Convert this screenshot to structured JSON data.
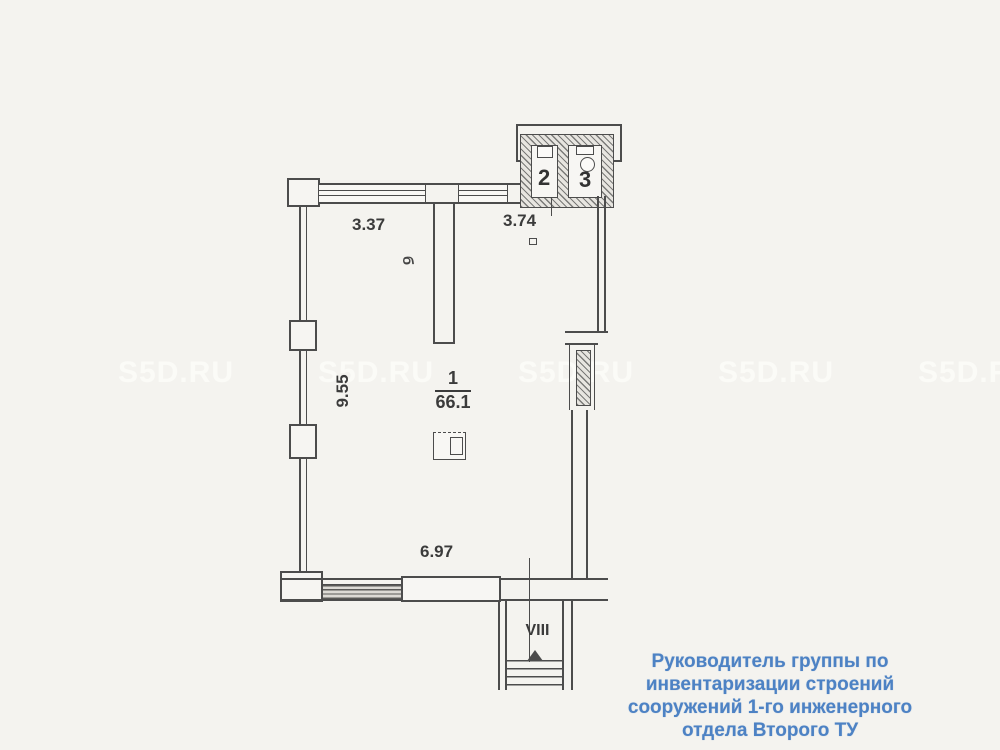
{
  "colors": {
    "background": "#f4f3ef",
    "line": "#4c4c4c",
    "signature_blue": "#4d82c4",
    "watermark": "#fdfdfa"
  },
  "watermark": {
    "text": "S5D.RU"
  },
  "plan": {
    "room1": {
      "number": "1",
      "area": "66.1"
    },
    "room2": {
      "number": "2"
    },
    "room3": {
      "number": "3"
    },
    "dim_top_left": "3.37",
    "dim_top_right": "3.74",
    "dim_left": "9.55",
    "dim_bottom": "6.97",
    "partition_mark": "б",
    "entrance": "VIII"
  },
  "signature": {
    "lines": [
      "Руководитель группы по",
      "инвентаризации строений",
      "сооружений 1-го инженерного",
      "отдела Второго ТУ"
    ]
  }
}
